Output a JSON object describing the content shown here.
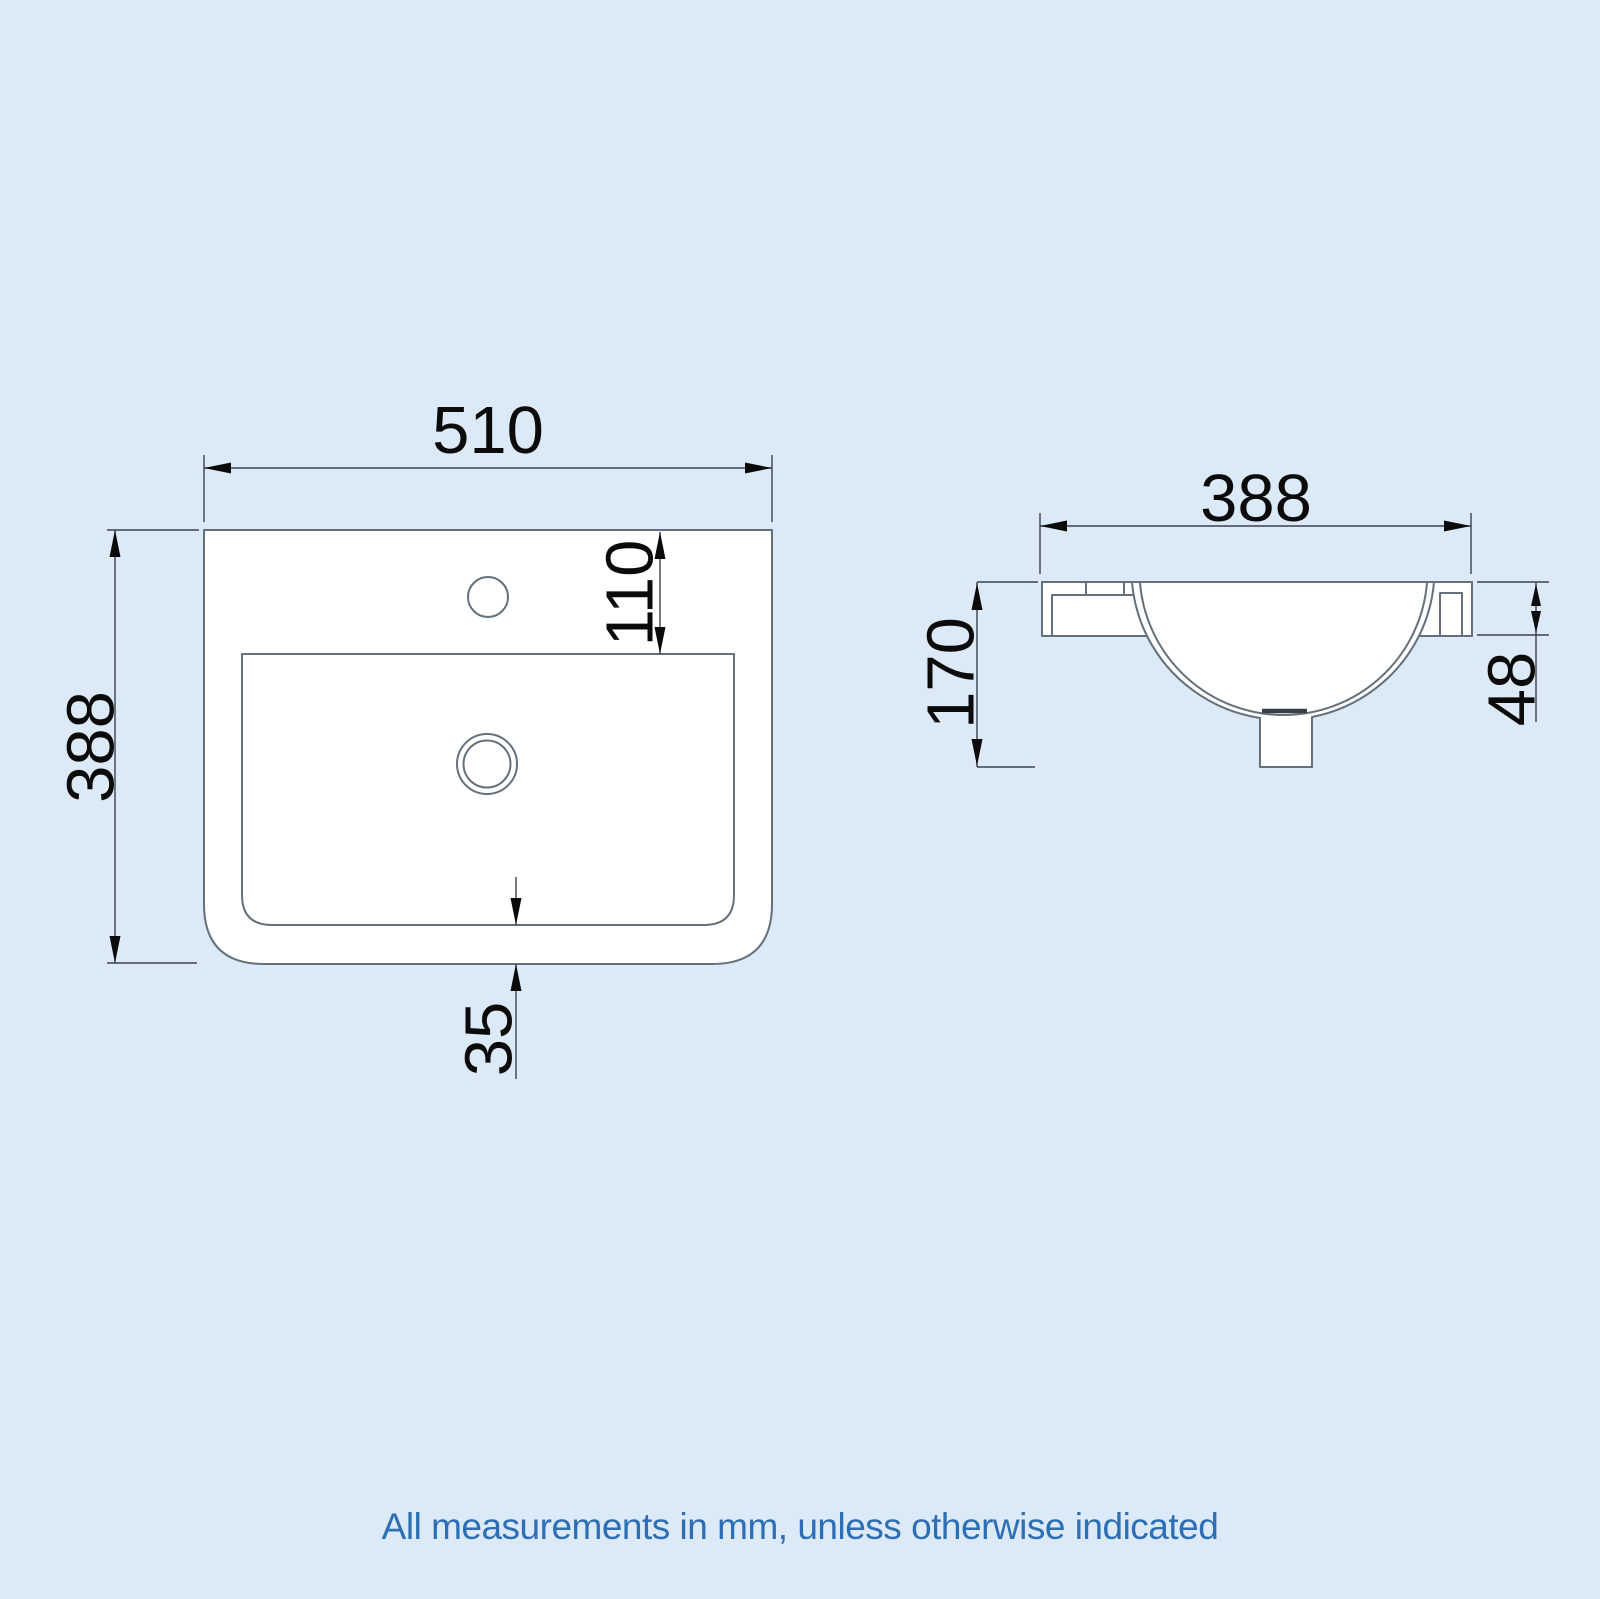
{
  "title": "Basin technical drawing",
  "units_note": "mm",
  "colors": {
    "background": "#dce9f7",
    "outline_line": "#64707c",
    "dimension_line": "#3a424b",
    "dimension_text": "#0b0b0b",
    "footer_text": "#2e6eb5",
    "shape_fill": "#ffffff"
  },
  "plan_view": {
    "name": "basin plan (top) view",
    "dims": {
      "width": "510",
      "depth": "388",
      "tap_hole_offset": "110",
      "bowl_to_front_edge": "35"
    }
  },
  "side_view": {
    "name": "basin side section view",
    "dims": {
      "depth": "388",
      "height": "170",
      "rim_height": "48"
    }
  },
  "footer": {
    "note": "All measurements in mm, unless otherwise indicated"
  }
}
